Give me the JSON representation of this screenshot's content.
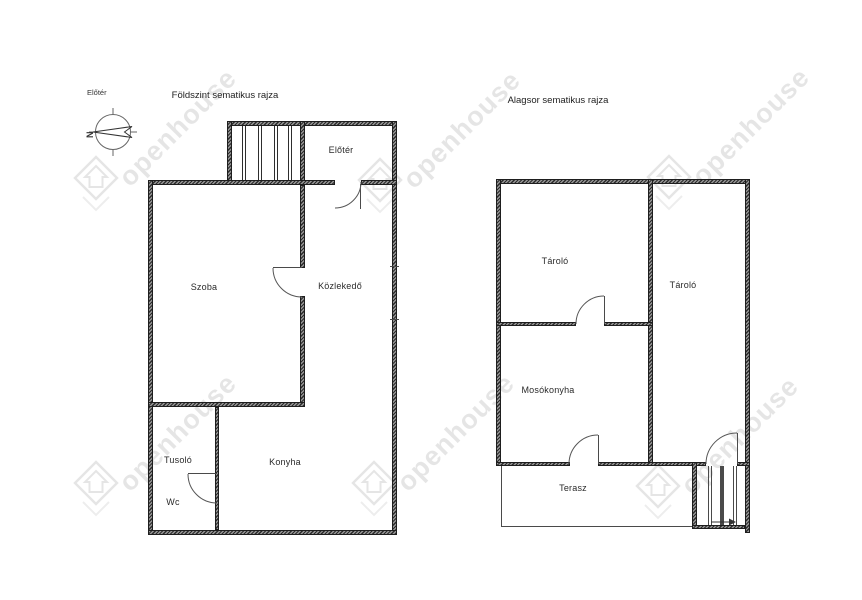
{
  "corner_label": "Előtér",
  "compass": {
    "north_letter": "N"
  },
  "watermark": {
    "text": "openhouse",
    "color": "#e3e3e3"
  },
  "plans": {
    "ground": {
      "title": "Földszint sematikus rajza",
      "rooms": [
        {
          "name": "Előtér"
        },
        {
          "name": "Szoba"
        },
        {
          "name": "Közlekedő"
        },
        {
          "name": "Tusoló"
        },
        {
          "name": "Wc"
        },
        {
          "name": "Konyha"
        }
      ]
    },
    "basement": {
      "title": "Alagsor sematikus rajza",
      "rooms": [
        {
          "name": "Tároló"
        },
        {
          "name": "Tároló"
        },
        {
          "name": "Mosókonyha"
        },
        {
          "name": "Terasz"
        }
      ]
    }
  },
  "colors": {
    "wall": "#2b2b2b",
    "thin_line": "#4a4a4a",
    "label": "#2a2a2a"
  }
}
